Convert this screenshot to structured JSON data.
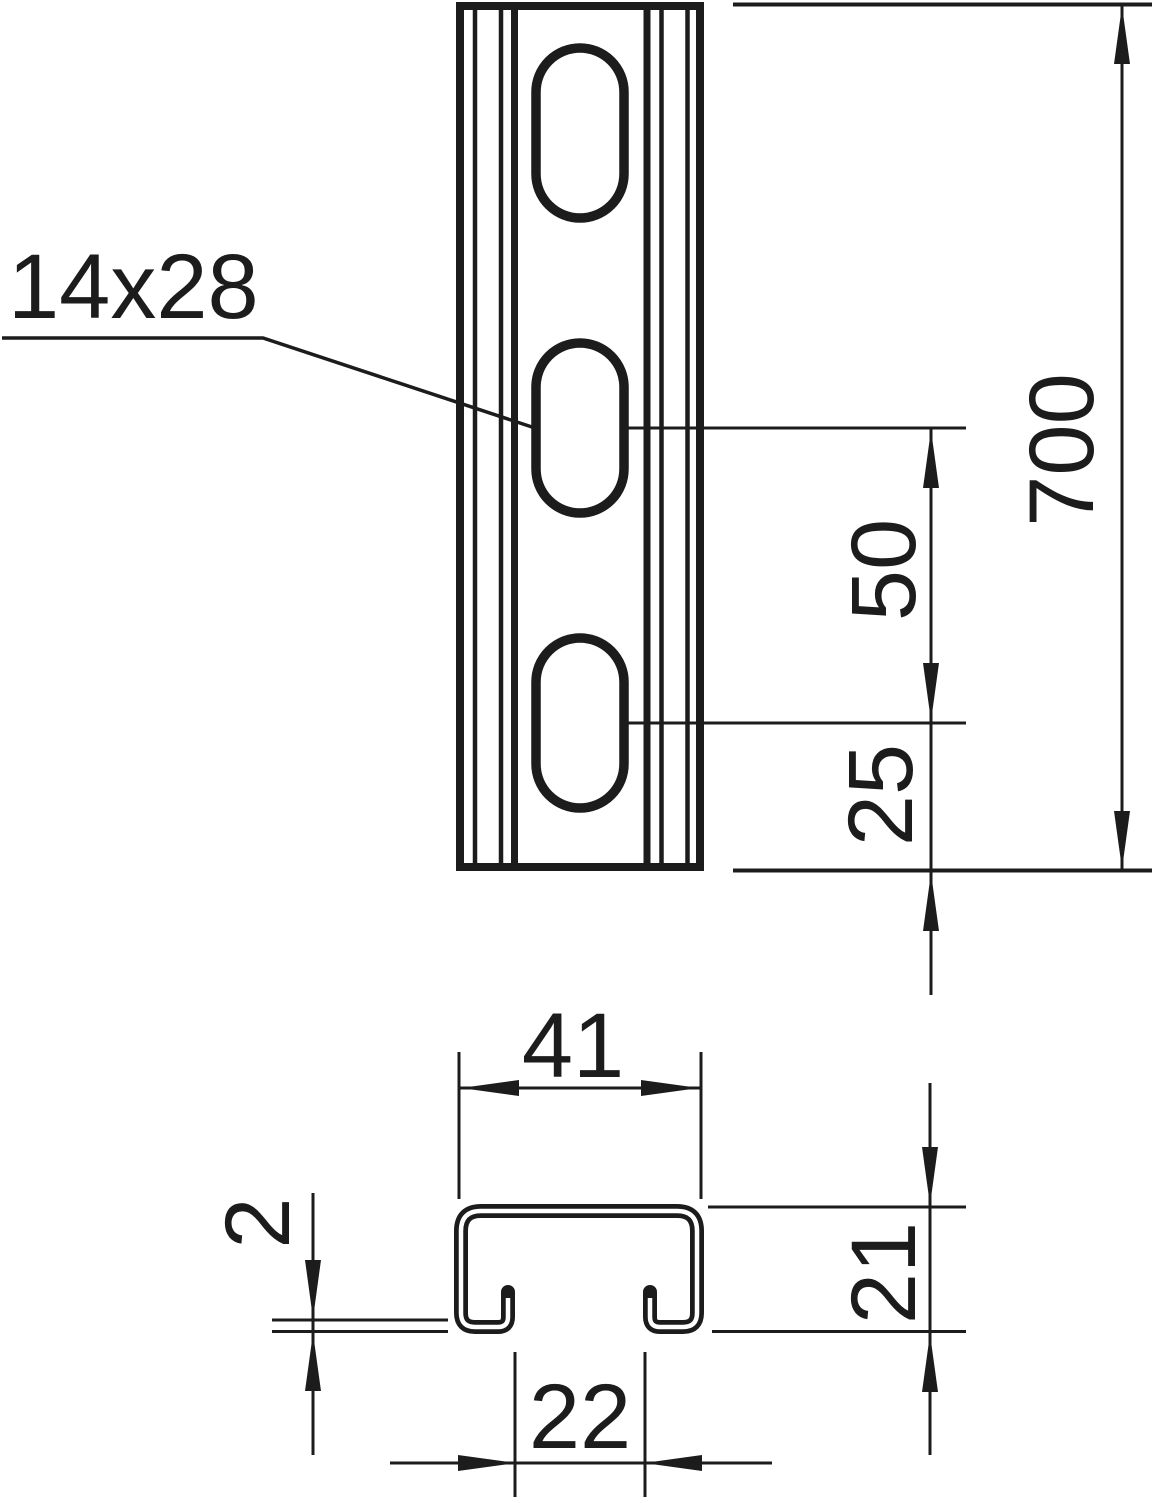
{
  "drawing": {
    "title": "slotted profile rail technical drawing",
    "line_color": "#1c1c1c",
    "background": "#ffffff",
    "front_view": {
      "slot_label": "14x28",
      "slot_count": 3,
      "dim_length": "700",
      "dim_pitch": "50",
      "dim_end_offset": "25"
    },
    "section_view": {
      "dim_width": "41",
      "dim_height": "21",
      "dim_thickness": "2",
      "dim_opening": "22"
    }
  }
}
